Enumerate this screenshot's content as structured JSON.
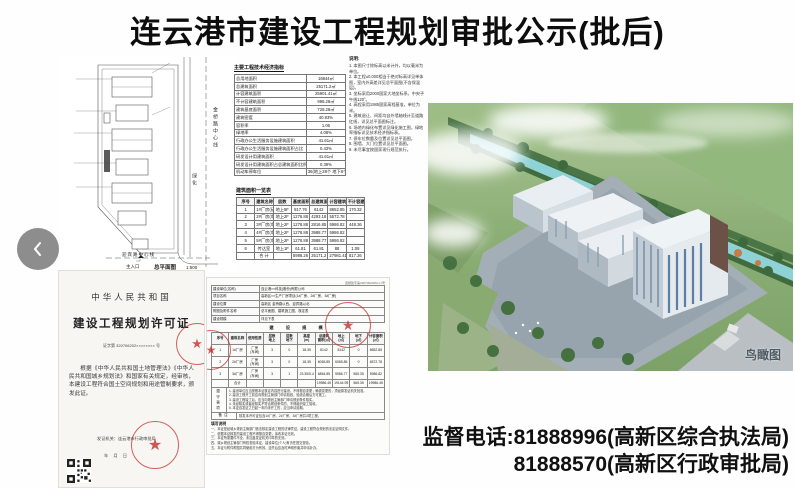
{
  "page": {
    "title": "连云港市建设工程规划审批公示(批后)"
  },
  "carousel": {
    "prev": "previous"
  },
  "site_plan": {
    "road_right_label": "金桥路中心线",
    "green_label": "绿化",
    "road_bottom_label": "迎宾路中心线",
    "entrance_label": "主入口",
    "caption": "总平面图",
    "scale": "1:500"
  },
  "indicators": {
    "title": "主要工程技术经济指标",
    "rows": [
      [
        "总用地面积",
        "16844㎡"
      ],
      [
        "总建筑面积",
        "25171.2㎡"
      ],
      [
        "计容建筑面积",
        "25901.41㎡"
      ],
      [
        "不计容建筑面积",
        "998.28㎡"
      ],
      [
        "建筑基底面积",
        "728.28㎡"
      ],
      [
        "建筑密度",
        "40.93%"
      ],
      [
        "容积率",
        "1.06"
      ],
      [
        "绿地率",
        "4.08%"
      ],
      [
        "行政办公生活服务设施建筑面积",
        "41.61㎡"
      ],
      [
        "行政办公生活服务设施建筑面积占比",
        "0.43%"
      ],
      [
        "研发设计用建筑面积",
        "41.61㎡"
      ],
      [
        "研发设计用建筑面积占总建筑面积比例",
        "0.39%"
      ],
      [
        "机动车停车位",
        "36(地上28个 地下8个)"
      ],
      [
        "非机动车停车位",
        "88"
      ]
    ]
  },
  "notes": {
    "title": "说明:",
    "lines": [
      "1. 本图尺寸除标高以米计外，均以毫米为单位。",
      "2. 本工程±0.000相当于绝对标高详见单体图，室内外高差详见总平面图(不含保温层)。",
      "3. 坐标采用2000国家大地坐标系，中央子午线120°。",
      "4. 高程采用1985国家高程基准，单位为米。",
      "5. 建筑退让、间距均自外墙轴线计至道路红线，详见总平面图标注。",
      "6. 场地内绿化布置详见绿化施工图，绿地率指标详见技术经济指标表。",
      "7. 停车位数量及位置详见总平面图。",
      "8. 围墙、大门位置详见总平面图。",
      "9. 未尽事宜按国家现行规范执行。"
    ]
  },
  "area_table": {
    "title": "建筑面积一览表",
    "grid": [
      [
        "序号",
        "建筑名称",
        "层数",
        "基底面积\n(㎡)",
        "总建筑面积\n(㎡)",
        "计容建筑面积\n(㎡)",
        "不计容建筑面积\n(㎡)"
      ],
      [
        "1",
        "1#厂房(研发楼)",
        "地上5F",
        "817.76",
        "6142",
        "8652.85",
        "170.32"
      ],
      [
        "2",
        "2#厂房(车间)",
        "地上2F",
        "1276.88",
        "4293.18",
        "5572.78",
        ""
      ],
      [
        "3",
        "3#厂房(车间)",
        "地上2F",
        "1276.88",
        "2816.85",
        "5986.82",
        "448.36"
      ],
      [
        "4",
        "4#厂房(车间)",
        "地上2F",
        "1276.88",
        "3988.77",
        "5986.82",
        ""
      ],
      [
        "5",
        "5#厂房(车间)",
        "地上2F",
        "1276.88",
        "3988.77",
        "5986.82",
        ""
      ],
      [
        "6",
        "传达室",
        "地上1F",
        "61.81",
        "61.81",
        "88",
        "1.08"
      ],
      [
        "",
        "合 计",
        "",
        "5986.26",
        "25171.2",
        "27981.41",
        "817.26"
      ]
    ]
  },
  "photo": {
    "caption": "鸟瞰图"
  },
  "certificate": {
    "country": "中华人民共和国",
    "title": "建设工程规划许可证",
    "no_line": "证字第 320706202×××××××× 号",
    "body": "根据《中华人民共和国土地管理法》《中华人民共和国城乡规划法》和国家有关规定，经审核，本建设工程符合国土空间规划和用途管制要求，颁发此证。",
    "issuer_line": "发证机关：连云港市行政审批局",
    "date_line": "年    月    日"
  },
  "permit_sheet": {
    "doc_no": "连规建字第3207062025×××号",
    "fields": [
      [
        "建设单位(名称)",
        "连云港××科技(股份)有限公司"
      ],
      [
        "项目名称",
        "高新区××生产厂房项目(1#厂房、2#厂房、3#厂房)"
      ],
      [
        "建设位置",
        "高新区 金桥路以西、迎宾路以北"
      ],
      [
        "附图及附件名称",
        "总平面图、建筑施工图、核定表"
      ],
      [
        "建设规模",
        "详见下表"
      ]
    ],
    "scale_title": "建　设　规　模",
    "grid": [
      [
        "序号",
        "建筑名称",
        "使用性质",
        "层数\n地上",
        "层数\n地下",
        "高度\n(m)",
        "总建筑\n面积(㎡)",
        "地上\n(㎡)",
        "地下\n(㎡)",
        "计容面积\n(㎡)"
      ],
      [
        "1",
        "1#厂房",
        "厂房\n(车间)",
        "3",
        "0",
        "18.35",
        "8142",
        "8142",
        "0",
        "8652.85"
      ],
      [
        "2",
        "2#厂房",
        "厂房\n(车间)",
        "3",
        "0",
        "18.35",
        "6065.85",
        "6065.85",
        "0",
        "6572.78"
      ],
      [
        "3",
        "3#厂房",
        "厂房\n(车间)",
        "3",
        "1",
        "23.35/5.4",
        "6864.85",
        "5986.77",
        "565.35",
        "5986.82"
      ],
      [
        "",
        "合计",
        "",
        "",
        "",
        "",
        "19986.45",
        "19144.95",
        "565.35",
        "19986.45"
      ]
    ],
    "observe_label": "遵守事项",
    "observe_lines": [
      "1. 建设单位应当按照本证核定内容进行建设，不得擅自变更；确需变更的，须经原发证机关批准。",
      "2. 建设工程开工前应向规划主管部门申请验线，验线合格后方可施工。",
      "3. 建设工程竣工后，应当向规划主管部门申请规划条件核实。",
      "4. 未经核实或者经核实不符合规划条件的，不得组织竣工验收。",
      "5. 本证自发证之日起一年内未开工的，应当申请延期。"
    ],
    "remark_label": "备注",
    "remark": "核发本许可证包含1#厂房、2#厂房、3#厂房共3项工程。",
    "fill_title": "填写说明",
    "fill_lines": [
      "一、本证是经城乡规划主管部门依法核定建设工程的法律凭证，建设工程符合规划的法定证明文件。",
      "二、依据本证核发的建设工程不得擅自变更，涂改本证无效。",
      "三、本证所需要件不全、未加盖发证机关印章的无效。",
      "四、城乡规划主管部门有权查验本证，建设单位(个人)有责任提交查验。",
      "五、本证与附件附图共同使用方为有效，遗失后应及时声明作废并申请补办。"
    ]
  },
  "phones": {
    "line1": "监督电话:81888996(高新区综合执法局)",
    "line2": "81888570(高新区行政审批局)"
  }
}
